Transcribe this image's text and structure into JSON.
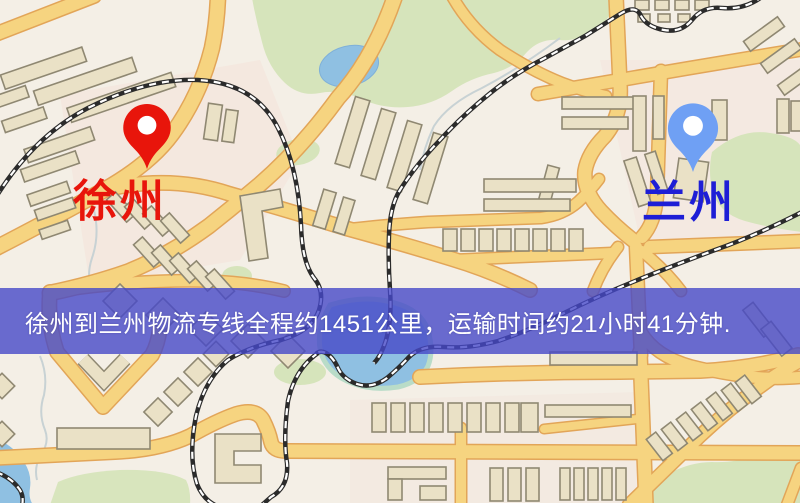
{
  "map_labels": {
    "origin": {
      "name": "徐州",
      "marker_color": "#e8150b",
      "label_color": "#e8150b"
    },
    "destination": {
      "name": "兰州",
      "marker_color": "#6fa0f4",
      "label_color": "#1e1ed6"
    }
  },
  "banner": {
    "text": "徐州到兰州物流专线全程约1451公里，运输时间约21小时41分钟.",
    "background_rgba": "rgba(70,72,200,0.8)",
    "text_color": "#ffffff",
    "route": {
      "from": "徐州",
      "to": "兰州",
      "distance_km": "1451",
      "duration_hours": "21",
      "duration_minutes": "41"
    }
  },
  "map_theme": {
    "background": "#f4efe6",
    "road_fill": "#f6d480",
    "road_casing": "#e2a558",
    "building_fill": "#eae1c6",
    "building_stroke": "#8f8872",
    "park_green": "#d6e4bb",
    "water_blue": "#8fc0e2",
    "railway": "#2b2b2b"
  }
}
